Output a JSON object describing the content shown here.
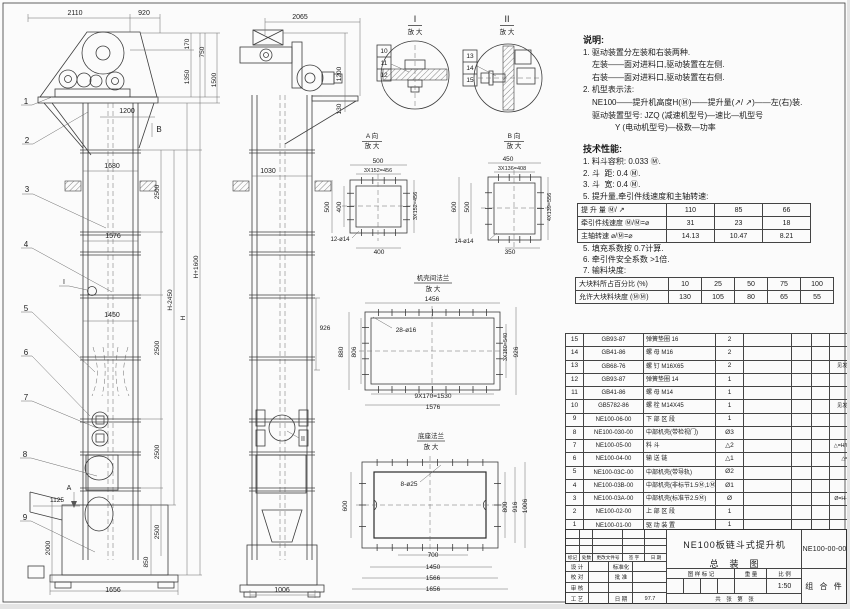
{
  "annotations": [
    {
      "x": 75,
      "y": 15,
      "t": "2110"
    },
    {
      "x": 144,
      "y": 15,
      "t": "920"
    },
    {
      "x": 189,
      "y": 44,
      "t": "170",
      "r": -90,
      "s": 6.5
    },
    {
      "x": 204,
      "y": 52,
      "t": "750",
      "r": -90,
      "s": 6.5
    },
    {
      "x": 189,
      "y": 77,
      "t": "1350",
      "r": -90,
      "s": 6.5
    },
    {
      "x": 216,
      "y": 80,
      "t": "1500",
      "r": -90,
      "s": 6.5
    },
    {
      "x": 127,
      "y": 113,
      "t": "1200"
    },
    {
      "x": 159,
      "y": 132,
      "t": "B",
      "s": 8
    },
    {
      "x": 112,
      "y": 168,
      "t": "1680"
    },
    {
      "x": 159,
      "y": 192,
      "t": "2500",
      "r": -90,
      "s": 6.5
    },
    {
      "x": 159,
      "y": 348,
      "t": "2500",
      "r": -90,
      "s": 6.5
    },
    {
      "x": 159,
      "y": 452,
      "t": "2500",
      "r": -90,
      "s": 6.5
    },
    {
      "x": 159,
      "y": 532,
      "t": "2500",
      "r": -90,
      "s": 6.5
    },
    {
      "x": 172,
      "y": 300,
      "t": "H-2450",
      "r": -90,
      "s": 6.5
    },
    {
      "x": 185,
      "y": 318,
      "t": "H",
      "r": -90,
      "s": 6.5
    },
    {
      "x": 198,
      "y": 267,
      "t": "H+1600",
      "r": -90,
      "s": 6.5
    },
    {
      "x": 113,
      "y": 238,
      "t": "1576"
    },
    {
      "x": 112,
      "y": 317,
      "t": "1450"
    },
    {
      "x": 57,
      "y": 502,
      "t": "1125",
      "s": 6.5
    },
    {
      "x": 50,
      "y": 548,
      "t": "2000",
      "r": -90,
      "s": 6.5
    },
    {
      "x": 148,
      "y": 562,
      "t": "850",
      "r": -90,
      "s": 6.5
    },
    {
      "x": 113,
      "y": 592,
      "t": "1656"
    },
    {
      "x": 26,
      "y": 104,
      "t": "1",
      "s": 8
    },
    {
      "x": 27,
      "y": 143,
      "t": "2",
      "s": 8
    },
    {
      "x": 27,
      "y": 192,
      "t": "3",
      "s": 8
    },
    {
      "x": 26,
      "y": 247,
      "t": "4",
      "s": 8
    },
    {
      "x": 26,
      "y": 311,
      "t": "5",
      "s": 8
    },
    {
      "x": 26,
      "y": 355,
      "t": "6",
      "s": 8
    },
    {
      "x": 26,
      "y": 400,
      "t": "7",
      "s": 8
    },
    {
      "x": 25,
      "y": 457,
      "t": "8",
      "s": 8
    },
    {
      "x": 25,
      "y": 520,
      "t": "9",
      "s": 8
    },
    {
      "x": 64,
      "y": 284,
      "t": "I",
      "s": 7
    },
    {
      "x": 69,
      "y": 490,
      "t": "A",
      "s": 7
    },
    {
      "x": 300,
      "y": 19,
      "t": "2065"
    },
    {
      "x": 341,
      "y": 74,
      "t": "1200",
      "r": -90,
      "s": 6.5
    },
    {
      "x": 341,
      "y": 109,
      "t": "130",
      "r": -90,
      "s": 6.5
    },
    {
      "x": 268,
      "y": 173,
      "t": "1030"
    },
    {
      "x": 325,
      "y": 330,
      "t": "926",
      "s": 6.5
    },
    {
      "x": 282,
      "y": 592,
      "t": "1006"
    },
    {
      "x": 303,
      "y": 441,
      "t": "II",
      "s": 7
    },
    {
      "x": 415,
      "y": 22,
      "t": "I",
      "s": 9
    },
    {
      "x": 415,
      "y": 34,
      "t": "放 大",
      "s": 6.5
    },
    {
      "x": 507,
      "y": 22,
      "t": "II",
      "s": 9
    },
    {
      "x": 507,
      "y": 34,
      "t": "放 大",
      "s": 6.5
    },
    {
      "x": 384,
      "y": 53,
      "t": "10",
      "s": 6.5
    },
    {
      "x": 384,
      "y": 65,
      "t": "11",
      "s": 6.5
    },
    {
      "x": 384,
      "y": 77,
      "t": "12",
      "s": 6.5
    },
    {
      "x": 470,
      "y": 58,
      "t": "13",
      "s": 6.5
    },
    {
      "x": 470,
      "y": 70,
      "t": "14",
      "s": 6.5
    },
    {
      "x": 470,
      "y": 82,
      "t": "15",
      "s": 6.5
    },
    {
      "x": 372,
      "y": 138,
      "t": "A 向",
      "s": 6.5
    },
    {
      "x": 372,
      "y": 148,
      "t": "放 大",
      "s": 6.5
    },
    {
      "x": 378,
      "y": 163,
      "t": "500",
      "s": 6.5
    },
    {
      "x": 378,
      "y": 172,
      "t": "3X152=456",
      "s": 5.5
    },
    {
      "x": 329,
      "y": 207,
      "t": "500",
      "r": -90,
      "s": 6.5
    },
    {
      "x": 341,
      "y": 207,
      "t": "400",
      "r": -90,
      "s": 6.5
    },
    {
      "x": 417,
      "y": 206,
      "t": "3X152=456",
      "r": -90,
      "s": 5.5
    },
    {
      "x": 340,
      "y": 241,
      "t": "12-ø14",
      "s": 6
    },
    {
      "x": 379,
      "y": 254,
      "t": "400",
      "s": 6.5
    },
    {
      "x": 514,
      "y": 138,
      "t": "B 向",
      "s": 6.5
    },
    {
      "x": 514,
      "y": 148,
      "t": "放 大",
      "s": 6.5
    },
    {
      "x": 508,
      "y": 161,
      "t": "450",
      "s": 6.5
    },
    {
      "x": 512,
      "y": 170,
      "t": "3X136=408",
      "s": 5.5
    },
    {
      "x": 456,
      "y": 207,
      "t": "600",
      "r": -90,
      "s": 6.5
    },
    {
      "x": 469,
      "y": 207,
      "t": "500",
      "r": -90,
      "s": 6.5
    },
    {
      "x": 551,
      "y": 207,
      "t": "4X139=556",
      "r": -90,
      "s": 5.5
    },
    {
      "x": 464,
      "y": 243,
      "t": "14-ø14",
      "s": 6
    },
    {
      "x": 510,
      "y": 254,
      "t": "350",
      "s": 6.5
    },
    {
      "x": 433,
      "y": 280,
      "t": "机壳间法兰",
      "s": 6.5
    },
    {
      "x": 433,
      "y": 291,
      "t": "放 大",
      "s": 6.5
    },
    {
      "x": 432,
      "y": 301,
      "t": "1456",
      "s": 6.5
    },
    {
      "x": 406,
      "y": 332,
      "t": "28-ø16",
      "s": 6.5
    },
    {
      "x": 343,
      "y": 352,
      "t": "880",
      "r": -90,
      "s": 6.5
    },
    {
      "x": 356,
      "y": 352,
      "t": "806",
      "r": -90,
      "s": 6.5
    },
    {
      "x": 507,
      "y": 347,
      "t": "3X180=540",
      "r": -90,
      "s": 5.5
    },
    {
      "x": 518,
      "y": 352,
      "t": "926",
      "r": -90,
      "s": 6.5
    },
    {
      "x": 433,
      "y": 398,
      "t": "9X170=1530",
      "s": 6.5
    },
    {
      "x": 433,
      "y": 409,
      "t": "1576",
      "s": 6.5
    },
    {
      "x": 431,
      "y": 438,
      "t": "底座法兰",
      "s": 6.5
    },
    {
      "x": 431,
      "y": 449,
      "t": "放 大",
      "s": 6.5
    },
    {
      "x": 409,
      "y": 486,
      "t": "8-ø25",
      "s": 6.5
    },
    {
      "x": 347,
      "y": 506,
      "t": "600",
      "r": -90,
      "s": 6.5
    },
    {
      "x": 507,
      "y": 507,
      "t": "800",
      "r": -90,
      "s": 6.5
    },
    {
      "x": 517,
      "y": 507,
      "t": "916",
      "r": -90,
      "s": 6.5
    },
    {
      "x": 527,
      "y": 506,
      "t": "1006",
      "r": -90,
      "s": 6.5
    },
    {
      "x": 433,
      "y": 557,
      "t": "700",
      "s": 6.5
    },
    {
      "x": 433,
      "y": 569,
      "t": "1450",
      "s": 6.5
    },
    {
      "x": 433,
      "y": 580,
      "t": "1566",
      "s": 6.5
    },
    {
      "x": 433,
      "y": 591,
      "t": "1656",
      "s": 6.5
    }
  ],
  "notes": {
    "title": "说明:",
    "items": [
      {
        "t": "1. 驱动装置分左装和右装两种.",
        "i": 0
      },
      {
        "t": "左装——面对进料口,驱动装置在左侧.",
        "i": 1
      },
      {
        "t": "右装——面对进料口,驱动装置在右侧.",
        "i": 1
      },
      {
        "t": "2. 机型表示法:",
        "i": 0
      },
      {
        "t": "NE100——提升机高度H(Ⓜ)——提升量(↗/ ↗)——左(右)装.",
        "i": 1
      },
      {
        "t": "驱动装置型号: JZQ (减速机型号)—速比—机型号",
        "i": 1
      },
      {
        "t": "Y (电动机型号)—极数—功率",
        "i": 2
      }
    ],
    "tech_title": "技术性能:",
    "tech_items": [
      {
        "t": "1. 料斗容积: 0.033 Ⓜ.",
        "i": 0
      },
      {
        "t": "2. 斗  距: 0.4 Ⓜ.",
        "i": 0
      },
      {
        "t": "3. 斗  宽: 0.4 Ⓜ.",
        "i": 0
      },
      {
        "t": "5. 提升量,牵引件线速度和主轴转速:",
        "i": 0
      }
    ],
    "tech_items2": [
      {
        "t": "5. 填充系数按 0.7计算.",
        "i": 0
      },
      {
        "t": "6. 牵引件安全系数 >1倍.",
        "i": 0
      },
      {
        "t": "7. 输料块度:",
        "i": 0
      }
    ]
  },
  "performance_table": {
    "rows": [
      {
        "label": "提 升 量",
        "unit": "Ⓜ/ ↗",
        "values": [
          "110",
          "85",
          "66"
        ]
      },
      {
        "label": "牵引件线速度",
        "unit": "Ⓜ/Ⓜ=⌀",
        "values": [
          "31",
          "23",
          "18"
        ]
      },
      {
        "label": "主轴转速",
        "unit": "⌀/Ⓜ=⌀",
        "values": [
          "14.13",
          "10.47",
          "8.21"
        ]
      }
    ]
  },
  "lump_table": {
    "rows": [
      {
        "label": "大块料所占百分比 (%)",
        "values": [
          "10",
          "25",
          "50",
          "75",
          "100"
        ]
      },
      {
        "label": "允许大块料块度 (ⓂⓂ)",
        "values": [
          "130",
          "105",
          "80",
          "65",
          "55"
        ]
      }
    ]
  },
  "bom": {
    "header": [
      "序号",
      "代  号",
      "名  称",
      "数 量",
      "材  料",
      "单重",
      "总重",
      "备 注"
    ],
    "rows": [
      {
        "no": "15",
        "code": "GB93-87",
        "name": "弹簧垫圈  16",
        "qty": "2",
        "material": "",
        "uw": "",
        "tw": "",
        "remark": ""
      },
      {
        "no": "14",
        "code": "GB41-86",
        "name": "螺 母  M16",
        "qty": "2",
        "material": "",
        "uw": "",
        "tw": "",
        "remark": ""
      },
      {
        "no": "13",
        "code": "GB68-76",
        "name": "螺 钉  M16X65",
        "qty": "2",
        "material": "",
        "uw": "",
        "tw": "",
        "remark": "见发货清单"
      },
      {
        "no": "12",
        "code": "GB93-87",
        "name": "弹簧垫圈  14",
        "qty": "1",
        "material": "",
        "uw": "",
        "tw": "",
        "remark": ""
      },
      {
        "no": "11",
        "code": "GB41-86",
        "name": "螺 母  M14",
        "qty": "1",
        "material": "",
        "uw": "",
        "tw": "",
        "remark": ""
      },
      {
        "no": "10",
        "code": "GB5782-86",
        "name": "螺 栓  M14X45",
        "qty": "1",
        "material": "",
        "uw": "",
        "tw": "",
        "remark": "见发货清单"
      },
      {
        "no": "9",
        "code": "NE100-06-00",
        "name": "下 部 区 段",
        "qty": "1",
        "material": "",
        "uw": "",
        "tw": "",
        "remark": ""
      },
      {
        "no": "8",
        "code": "NE100-030-00",
        "name": "中部机壳(带检视门)",
        "qty": "Ø3",
        "material": "",
        "uw": "",
        "tw": "",
        "remark": ""
      },
      {
        "no": "7",
        "code": "NE100-05-00",
        "name": "料  斗",
        "qty": "△2",
        "material": "",
        "uw": "",
        "tw": "",
        "remark": "△=H/0.2+5.75"
      },
      {
        "no": "6",
        "code": "NE100-04-00",
        "name": "输 送 链",
        "qty": "△1",
        "material": "",
        "uw": "",
        "tw": "",
        "remark": "△=△X4"
      },
      {
        "no": "5",
        "code": "NE100-03C-00",
        "name": "中部机壳(带导轨)",
        "qty": "Ø2",
        "material": "",
        "uw": "",
        "tw": "",
        "remark": ""
      },
      {
        "no": "4",
        "code": "NE100-03B-00",
        "name": "中部机壳(非标节1.5Ⓜ,1Ⓜ)",
        "qty": "Ø1",
        "material": "",
        "uw": "",
        "tw": "",
        "remark": ""
      },
      {
        "no": "3",
        "code": "NE100-03A-00",
        "name": "中部机壳(标准节2.5Ⓜ)",
        "qty": "Ø",
        "material": "",
        "uw": "",
        "tw": "",
        "remark": "Ø=H-3.15/2.5"
      },
      {
        "no": "2",
        "code": "NE100-02-00",
        "name": "上 部 区 段",
        "qty": "1",
        "material": "",
        "uw": "",
        "tw": "",
        "remark": ""
      },
      {
        "no": "1",
        "code": "NE100-01-00",
        "name": "驱 动 装 置",
        "qty": "1",
        "material": "",
        "uw": "",
        "tw": "",
        "remark": ""
      }
    ]
  },
  "title_block": {
    "rev_header": [
      "标记",
      "处数",
      "更改文件号",
      "签 字",
      "日 期"
    ],
    "sig_rows": [
      {
        "c1": "设 计",
        "c2": "",
        "c3": "标准化",
        "c4": ""
      },
      {
        "c1": "校 对",
        "c2": "",
        "c3": "批 准",
        "c4": ""
      },
      {
        "c1": "审 核",
        "c2": "",
        "c3": "",
        "c4": ""
      },
      {
        "c1": "工 艺",
        "c2": "",
        "c3": "日 期",
        "c4": "97.7"
      }
    ],
    "title_line1": "NE100板链斗式提升机",
    "title_line2": "总　装　图",
    "mark_header": "图 样 标 记",
    "weight_header": "重 量",
    "scale_header": "比 例",
    "scale": "1:50",
    "sheet_note": "共　张　第　张",
    "drawing_no": "NE100-00-00",
    "part_class": "组 合 件"
  }
}
